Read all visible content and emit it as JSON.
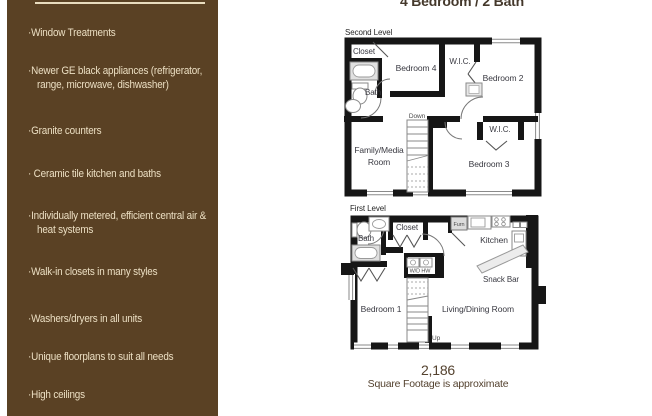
{
  "title": "4 Bedroom / 2 Bath",
  "sidebar": {
    "features": [
      "·Window Treatments",
      "·Newer GE black appliances (refrigerator, range, microwave, dishwasher)",
      "·Granite counters",
      "· Ceramic tile kitchen and baths",
      "·Individually metered, efficient central air & heat systems",
      "·Walk-in closets in many styles",
      "·Washers/dryers in all units",
      "·Unique floorplans to suit all needs",
      "·High ceilings"
    ]
  },
  "second_level": {
    "label": "Second Level",
    "rooms": {
      "closet": "Closet",
      "bath": "Bath",
      "bedroom4": "Bedroom 4",
      "wic_top": "W.I.C.",
      "bedroom2": "Bedroom 2",
      "stairs": "Down",
      "family_line1": "Family/Media",
      "family_line2": "Room",
      "wic_right": "W.I.C.",
      "bedroom3": "Bedroom 3"
    }
  },
  "first_level": {
    "label": "First Level",
    "rooms": {
      "bath": "Bath",
      "closet": "Closet",
      "furnace": "Furn",
      "kitchen": "Kitchen",
      "washer_dryer": "W/D HW",
      "snack_bar": "Snack Bar",
      "bedroom1": "Bedroom 1",
      "living": "Living/Dining Room",
      "stairs": "Up"
    }
  },
  "footer": {
    "square_footage": "2,186",
    "note": "Square Footage is approximate"
  },
  "colors": {
    "sidebar_bg": "#5a4124",
    "sidebar_text": "#ecdfc3",
    "wall": "#161616",
    "room_label": "#3a3a42",
    "heading_text": "#44382b"
  }
}
